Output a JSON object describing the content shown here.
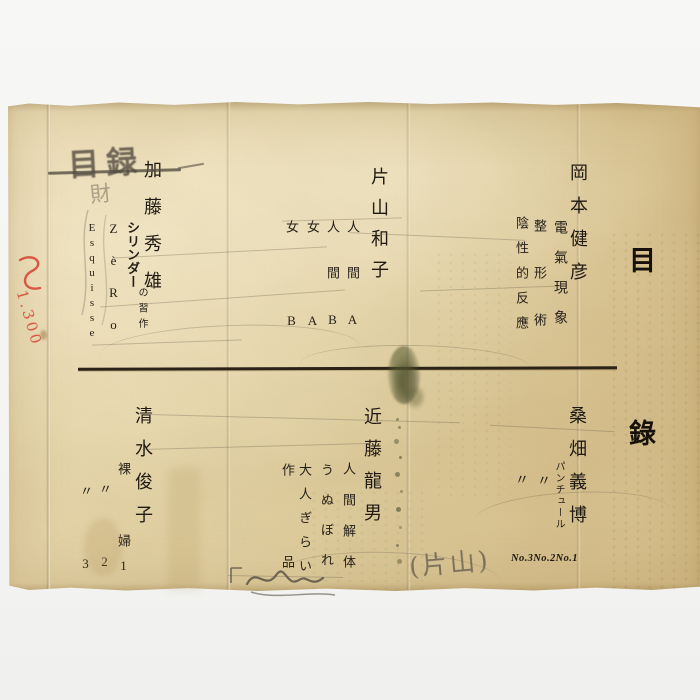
{
  "document": {
    "title": "目錄",
    "top_row": {
      "kato": {
        "name": "加藤秀雄",
        "work1_main": "シリンダー",
        "work1_sub": "の習作",
        "work2": "ZèRo",
        "work3": "Esquisse"
      },
      "katayama": {
        "name": "片山和子",
        "work1": "人間A",
        "work2": "人間B",
        "work3": "女A",
        "work4": "女B"
      },
      "okamoto": {
        "name": "岡本健彦",
        "work1": "電氣現象",
        "work2": "整形術",
        "work3": "陰性的反應"
      }
    },
    "bottom_row": {
      "shimizu": {
        "name": "清水俊子",
        "work1": "裸　　婦1",
        "work2": "〃　　2",
        "work3": "〃　　3"
      },
      "kondo": {
        "name": "近藤龍男",
        "work1": "人間解体",
        "work2": "うぬぼれ",
        "work3": "大人ぎらい",
        "work4": "作品"
      },
      "kuwahata": {
        "name": "桑畑義博",
        "work1": "パンチュール",
        "ditto1": "〃",
        "ditto2": "〃",
        "numbers": "No.3No.2No.1"
      }
    },
    "handwriting": {
      "pencil_title": "目録",
      "pencil_char": "財",
      "red_note": "1.300",
      "pencil_note": "(片山)"
    }
  }
}
